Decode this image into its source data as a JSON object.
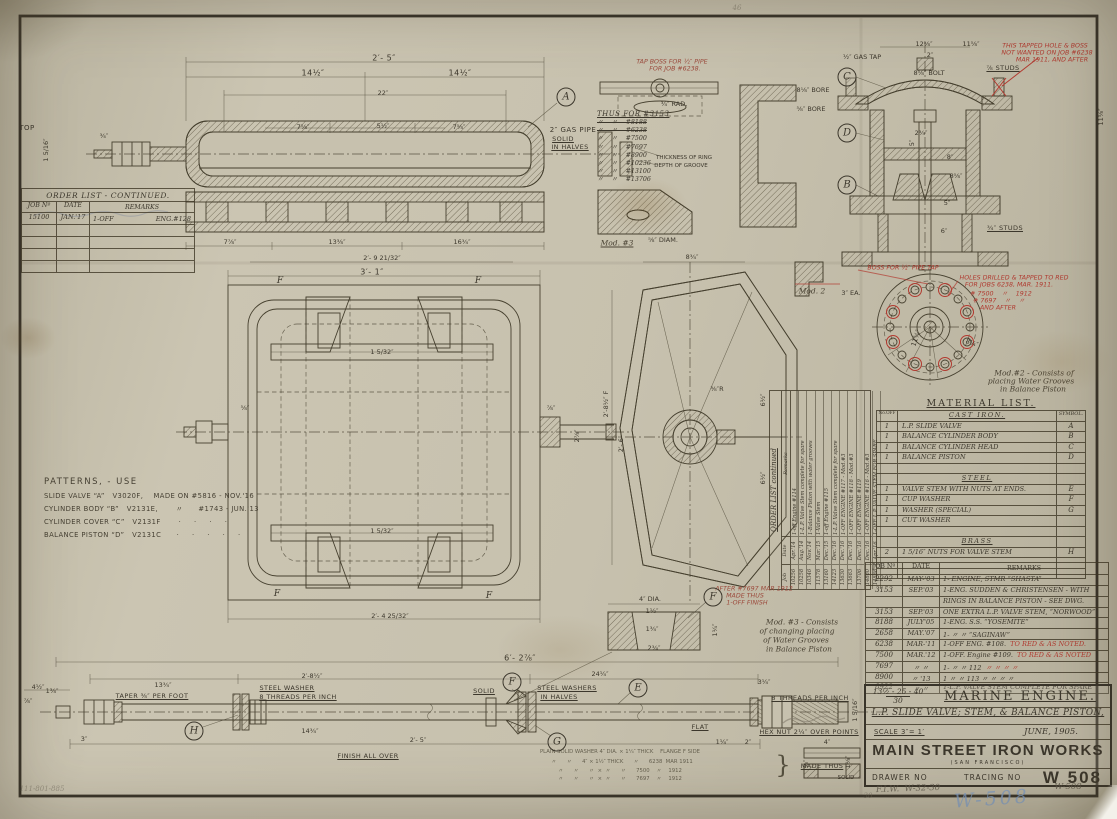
{
  "sheet": {
    "bg": "#c7c1ae",
    "ink": "#3c372c",
    "red": "#b03a30",
    "blue": "#7f9cc4"
  },
  "order_list_left": {
    "title": "ORDER LIST - CONTINUED.",
    "headers": [
      "JOB Nº",
      "DATE",
      "REMARKS"
    ],
    "rows": [
      {
        "job": "15100",
        "date": "JAN.'17",
        "rem": "1-OFF",
        "rem2": "ENG.#128"
      },
      {
        "job": "",
        "date": "",
        "rem": "",
        "rem2": ""
      },
      {
        "job": "",
        "date": "",
        "rem": "",
        "rem2": ""
      },
      {
        "job": "",
        "date": "",
        "rem": "",
        "rem2": ""
      },
      {
        "job": "",
        "date": "",
        "rem": "",
        "rem2": ""
      }
    ]
  },
  "patterns": {
    "title": "PATTERNS, - USE",
    "lines": [
      "SLIDE VALVE “A”   V3020F,    MADE ON #5816 - NOV.'16",
      "CYLINDER BODY “B”   V2131E,       〃      #1743 - JUN.'13",
      "CYLINDER COVER “C”   V2131F       ·     ·     ·     ·",
      "BALANCE PISTON “D”   V2131C      ·     ·     ·     ·     ·"
    ]
  },
  "thus_for": {
    "title": "THUS FOR #3153",
    "items": [
      {
        "t": "〃    〃    #8188",
        "s": true
      },
      {
        "t": "〃    〃    #6238",
        "s": true
      },
      {
        "t": "〃    〃    #7500",
        "s": false
      },
      {
        "t": "〃    〃    #7697",
        "s": false
      },
      {
        "t": "〃    〃    #8900",
        "s": false
      },
      {
        "t": "〃    〃    #10236",
        "s": false
      },
      {
        "t": "〃    〃    #13100",
        "s": false
      },
      {
        "t": "〃    〃    #13706",
        "s": false
      }
    ]
  },
  "rotated_order_list": {
    "title": "ORDER LIST continued",
    "headers": [
      "Job",
      "Date",
      "Remarks"
    ],
    "rows": [
      [
        "10256",
        "Apr.'14",
        "1-off Engine #114"
      ],
      [
        "10258",
        "Aug.'14",
        "1-L.P. Valve Stem complete for spare"
      ],
      [
        "10346",
        "Nov.'14",
        "1-Balance Piston with water grooves"
      ],
      [
        "11578",
        "Mar.'15",
        "1-Valve Stem"
      ],
      [
        "13160",
        "Dec.'15",
        "1-off Engine #115"
      ],
      [
        "14123",
        "Dec.'16",
        "1-L.P. Valve Stem complete for spare"
      ],
      [
        "13630",
        "Dec.'16",
        "1-OFF ENGINE #117 - Mod.#3"
      ],
      [
        "13663",
        "Dec.'16",
        "1-OFF ENGINE #118 - Mod.#3"
      ],
      [
        "13706",
        "Dec.'16",
        "1-OFF ENGINE #119"
      ],
      [
        "14880",
        "Dec.'16",
        "1-OFF ENGINE #116 - Mod.#3"
      ],
      [
        "14888",
        "Apr.'16",
        "1-OFF L.P. VALVE STEM FOR SPARE"
      ]
    ]
  },
  "material_list": {
    "title": "MATERIAL LIST.",
    "col_no": "No.OFF",
    "col_sym": "SYMBOL.",
    "sections": [
      {
        "name": "CAST IRON.",
        "gap": 1,
        "rows": [
          [
            "1",
            "L.P. SLIDE VALVE",
            "A"
          ],
          [
            "1",
            "BALANCE CYLINDER BODY",
            "B"
          ],
          [
            "1",
            "BALANCE CYLINDER HEAD",
            "C"
          ],
          [
            "1",
            "BALANCE PISTON",
            "D"
          ]
        ]
      },
      {
        "name": "STEEL",
        "gap": 1,
        "rows": [
          [
            "1",
            "VALVE STEM WITH NUTS AT ENDS.",
            "E"
          ],
          [
            "1",
            "CUP WASHER",
            "F"
          ],
          [
            "1",
            "WASHER  (SPECIAL)",
            "G"
          ],
          [
            "1",
            "CUT WASHER",
            ""
          ]
        ]
      },
      {
        "name": "BRASS",
        "gap": 2,
        "rows": [
          [
            "2",
            "1 5/16″ NUTS FOR VALVE STEM",
            "H"
          ]
        ]
      }
    ]
  },
  "record_table": {
    "headers": [
      "JOB Nº",
      "DATE",
      "REMARKS"
    ],
    "rows": [
      {
        "job": "2292",
        "date": "MAY-'03",
        "rem": "1- ENGINE,      STMR “SHASTA”",
        "red": ""
      },
      {
        "job": "3153",
        "date": "SEP.'03",
        "rem": "1-ENG. SUDDEN & CHRISTENSEN - WITH",
        "red": ""
      },
      {
        "job": "",
        "date": "",
        "rem": "RINGS IN BALANCE PISTON - SEE DWG.",
        "red": ""
      },
      {
        "job": "3153",
        "date": "SEP.'03",
        "rem": "ONE EXTRA L.P. VALVE STEM, “NORWOOD”",
        "red": ""
      },
      {
        "job": "8188",
        "date": "JULY'05",
        "rem": "1-ENG.   S.S. “YOSEMITE”",
        "red": ""
      },
      {
        "job": "2658",
        "date": "MAY.'07",
        "rem": "1- 〃      〃 “SAGINAW”",
        "red": ""
      },
      {
        "job": "6238",
        "date": "MAR-'11",
        "rem": "1-OFF  ENG. #108.",
        "red": "TO RED & AS NOTED."
      },
      {
        "job": "7500",
        "date": "MAR.'12",
        "rem": "1-OFF. Engine #109.",
        "red": "TO RED & AS NOTED"
      },
      {
        "job": "7697",
        "date": "〃   〃",
        "rem": "1- 〃       〃       112",
        "red": "〃   〃   〃   〃"
      },
      {
        "job": "8900",
        "date": "〃  '13",
        "rem": "1  〃       〃       113   〃   〃   〃   〃",
        "red": ""
      },
      {
        "job": "8922",
        "date": "〃   〃",
        "rem": "1-L.P. VALVE STEM COMPLETE FOR SPARE",
        "red": ""
      }
    ]
  },
  "title_block": {
    "ref_num": "13½ - 25 - 40",
    "ref_den": "30",
    "title": "MARINE ENGINE.",
    "subtitle": "L.P. SLIDE VALVE; STEM, & BALANCE PISTON,",
    "scale": "SCALE 3″= 1′",
    "date": "JUNE, 1905.",
    "company": "MAIN STREET IRON WORKS",
    "city": "(SAN FRANCISCO)",
    "drawer_label": "DRAWER NO",
    "tracing_label": "TRACING NO",
    "tracing_no": "W 508"
  },
  "annotations": [
    {
      "x": 737,
      "y": 8,
      "t": "46",
      "c": "pencilf",
      "n": "pencil-mark-46"
    },
    {
      "x": 27,
      "y": 128,
      "t": "TOP",
      "c": "lab",
      "n": "top-view-label"
    },
    {
      "x": 46,
      "y": 150,
      "t": "1 5/16″",
      "c": "dim",
      "r": -90
    },
    {
      "x": 104,
      "y": 136,
      "t": "¾″",
      "c": "dim"
    },
    {
      "x": 384,
      "y": 58,
      "t": "2′- 5″",
      "c": "dimb"
    },
    {
      "x": 313,
      "y": 73,
      "t": "14½″",
      "c": "dimb"
    },
    {
      "x": 460,
      "y": 73,
      "t": "14½″",
      "c": "dimb"
    },
    {
      "x": 383,
      "y": 93,
      "t": "22″",
      "c": "dim"
    },
    {
      "x": 303,
      "y": 127,
      "t": "7⅝″",
      "c": "dim"
    },
    {
      "x": 383,
      "y": 126,
      "t": "5½″",
      "c": "dim"
    },
    {
      "x": 459,
      "y": 127,
      "t": "7⅝″",
      "c": "dim"
    },
    {
      "x": 573,
      "y": 130,
      "t": "2″ GAS PIPE",
      "c": "lab",
      "n": "gas-pipe-label"
    },
    {
      "x": 563,
      "y": 139,
      "t": "SOLID",
      "c": "labu"
    },
    {
      "x": 570,
      "y": 147,
      "t": "IN HALVES",
      "c": "labu"
    },
    {
      "x": 230,
      "y": 242,
      "t": "7⅞″",
      "c": "dim"
    },
    {
      "x": 337,
      "y": 242,
      "t": "13⅜″",
      "c": "dim"
    },
    {
      "x": 462,
      "y": 242,
      "t": "16¾″",
      "c": "dim"
    },
    {
      "x": 382,
      "y": 258,
      "t": "2′- 9 21/32″",
      "c": "dim"
    },
    {
      "x": 372,
      "y": 272,
      "t": "3′- 1″",
      "c": "dimb"
    },
    {
      "x": 390,
      "y": 616,
      "t": "2′- 4 25/32″",
      "c": "dim"
    },
    {
      "x": 382,
      "y": 352,
      "t": "1 5/32″",
      "c": "dim"
    },
    {
      "x": 382,
      "y": 531,
      "t": "1 5/32″",
      "c": "dim"
    },
    {
      "x": 280,
      "y": 281,
      "t": "F",
      "c": "flab"
    },
    {
      "x": 478,
      "y": 281,
      "t": "F",
      "c": "flab"
    },
    {
      "x": 277,
      "y": 594,
      "t": "F",
      "c": "flab"
    },
    {
      "x": 489,
      "y": 596,
      "t": "F",
      "c": "flab"
    },
    {
      "x": 245,
      "y": 408,
      "t": "⅝″",
      "c": "dim"
    },
    {
      "x": 551,
      "y": 408,
      "t": "⅞″",
      "c": "dim"
    },
    {
      "x": 577,
      "y": 436,
      "t": "2⅞″",
      "c": "dim",
      "r": -90
    },
    {
      "x": 692,
      "y": 257,
      "t": "8¾″",
      "c": "dim"
    },
    {
      "x": 606,
      "y": 404,
      "t": "2′-8½″ F",
      "c": "dim",
      "r": -90
    },
    {
      "x": 621,
      "y": 444,
      "t": "2′- 6″",
      "c": "dim",
      "r": -90
    },
    {
      "x": 763,
      "y": 400,
      "t": "6½″",
      "c": "dim",
      "r": -90
    },
    {
      "x": 763,
      "y": 478,
      "t": "6½″",
      "c": "dim",
      "r": -90
    },
    {
      "x": 717,
      "y": 389,
      "t": "⅜″R",
      "c": "dim"
    },
    {
      "x": 672,
      "y": 62,
      "t": "TAP BOSS FOR ½″ PIPE",
      "c": "redf",
      "n": "tap-boss-note"
    },
    {
      "x": 675,
      "y": 69,
      "t": "FOR JOB #6238.",
      "c": "redf"
    },
    {
      "x": 674,
      "y": 104,
      "t": "¾″ RAD.",
      "c": "dim"
    },
    {
      "x": 813,
      "y": 90,
      "t": "8⅛″ BORE",
      "c": "dim"
    },
    {
      "x": 811,
      "y": 109,
      "t": "⅝″ BORE",
      "c": "dim"
    },
    {
      "x": 684,
      "y": 158,
      "t": "THICKNESS OF RING",
      "c": "labt"
    },
    {
      "x": 681,
      "y": 166,
      "t": "DEPTH OF GROOVE",
      "c": "labt"
    },
    {
      "x": 617,
      "y": 243,
      "t": "Mod. #3",
      "c": "scriptu",
      "n": "mod3-detail-label"
    },
    {
      "x": 663,
      "y": 240,
      "t": "⅝″ DIAM.",
      "c": "dim"
    },
    {
      "x": 862,
      "y": 57,
      "t": "½″ GAS TAP",
      "c": "dim"
    },
    {
      "x": 924,
      "y": 44,
      "t": "12⅝″",
      "c": "dim"
    },
    {
      "x": 971,
      "y": 44,
      "t": "11⅝″",
      "c": "dim"
    },
    {
      "x": 930,
      "y": 55,
      "t": "2″",
      "c": "dim"
    },
    {
      "x": 929,
      "y": 73,
      "t": "8⅝″ BOLT",
      "c": "dim"
    },
    {
      "x": 921,
      "y": 133,
      "t": "2¾″",
      "c": "dim"
    },
    {
      "x": 912,
      "y": 143,
      "t": "5″",
      "c": "dim",
      "r": -90
    },
    {
      "x": 950,
      "y": 157,
      "t": "8″",
      "c": "dim"
    },
    {
      "x": 956,
      "y": 176,
      "t": "8⅝″",
      "c": "dim"
    },
    {
      "x": 947,
      "y": 203,
      "t": "5″",
      "c": "dim"
    },
    {
      "x": 944,
      "y": 231,
      "t": "6″",
      "c": "dim"
    },
    {
      "x": 1101,
      "y": 117,
      "t": "11⅝″",
      "c": "dim",
      "r": -90
    },
    {
      "x": 1003,
      "y": 68,
      "t": "⅞ STUDS",
      "c": "labu"
    },
    {
      "x": 1005,
      "y": 228,
      "t": "¾″ STUDS",
      "c": "labu"
    },
    {
      "x": 1045,
      "y": 46,
      "t": "THIS TAPPED HOLE & BOSS",
      "c": "red",
      "n": "red-note-tapped-hole"
    },
    {
      "x": 1047,
      "y": 53,
      "t": "NOT WANTED ON JOB #6238",
      "c": "red"
    },
    {
      "x": 1052,
      "y": 60,
      "t": "MAR 1911, AND AFTER",
      "c": "red"
    },
    {
      "x": 812,
      "y": 291,
      "t": "Mod. 2",
      "c": "script",
      "n": "mod2-detail-label"
    },
    {
      "x": 851,
      "y": 293,
      "t": "3″ EA.",
      "c": "dim"
    },
    {
      "x": 903,
      "y": 268,
      "t": "BOSS FOR ½″ PIPE TAP",
      "c": "red",
      "n": "red-note-boss"
    },
    {
      "x": 1014,
      "y": 278,
      "t": "HOLES DRILLED & TAPPED TO RED",
      "c": "red",
      "n": "red-note-holes"
    },
    {
      "x": 1009,
      "y": 285,
      "t": "FOR JOBS 6238, MAR. 1911.",
      "c": "red"
    },
    {
      "x": 1001,
      "y": 293,
      "t": "# 7500    〃    1912",
      "c": "red"
    },
    {
      "x": 999,
      "y": 300,
      "t": "# 7697    〃    〃",
      "c": "red"
    },
    {
      "x": 998,
      "y": 308,
      "t": "AND AFTER",
      "c": "red"
    },
    {
      "x": 916,
      "y": 338,
      "t": "11⅝″",
      "c": "dim",
      "r": -72
    },
    {
      "x": 972,
      "y": 343,
      "t": "8¼″",
      "c": "dim",
      "r": 20
    },
    {
      "x": 1034,
      "y": 373,
      "t": "Mod.#2 - Consists of",
      "c": "script",
      "n": "mod2-note"
    },
    {
      "x": 1031,
      "y": 381,
      "t": "placing Water Grooves",
      "c": "script"
    },
    {
      "x": 1033,
      "y": 389,
      "t": "in Balance Piston",
      "c": "script"
    },
    {
      "x": 802,
      "y": 622,
      "t": "Mod. #3 - Consists",
      "c": "script",
      "n": "mod3-note"
    },
    {
      "x": 797,
      "y": 631,
      "t": "of changing placing",
      "c": "script"
    },
    {
      "x": 796,
      "y": 640,
      "t": "of Water Grooves",
      "c": "script"
    },
    {
      "x": 799,
      "y": 649,
      "t": "in Balance Piston",
      "c": "script"
    },
    {
      "x": 650,
      "y": 599,
      "t": "4″ DIA.",
      "c": "dim"
    },
    {
      "x": 652,
      "y": 611,
      "t": "1½″",
      "c": "dim"
    },
    {
      "x": 652,
      "y": 629,
      "t": "1¾″",
      "c": "dim"
    },
    {
      "x": 654,
      "y": 648,
      "t": "2¾″",
      "c": "dim"
    },
    {
      "x": 715,
      "y": 630,
      "t": "1¼″",
      "c": "dim",
      "r": -90
    },
    {
      "x": 754,
      "y": 589,
      "t": "AFTER #7697 MAR 1912",
      "c": "redf",
      "n": "after-7697-note"
    },
    {
      "x": 745,
      "y": 596,
      "t": "MADE THUS",
      "c": "redf"
    },
    {
      "x": 747,
      "y": 603,
      "t": "1-OFF FINISH",
      "c": "redf"
    },
    {
      "x": 38,
      "y": 687,
      "t": "4½″",
      "c": "dim"
    },
    {
      "x": 163,
      "y": 685,
      "t": "13¾″",
      "c": "dim"
    },
    {
      "x": 312,
      "y": 676,
      "t": "2′-8½″",
      "c": "dim"
    },
    {
      "x": 520,
      "y": 658,
      "t": "6′- 2⅞″",
      "c": "dimb"
    },
    {
      "x": 600,
      "y": 674,
      "t": "24¼″",
      "c": "dim"
    },
    {
      "x": 764,
      "y": 682,
      "t": "3¼″",
      "c": "dim"
    },
    {
      "x": 52,
      "y": 691,
      "t": "1⅜″",
      "c": "dim"
    },
    {
      "x": 28,
      "y": 701,
      "t": "⅞″",
      "c": "dim"
    },
    {
      "x": 152,
      "y": 696,
      "t": "TAPER ⅜″ PER FOOT",
      "c": "labu"
    },
    {
      "x": 287,
      "y": 688,
      "t": "STEEL WASHER",
      "c": "labu"
    },
    {
      "x": 298,
      "y": 697,
      "t": "8 THREADS PER INCH",
      "c": "labu"
    },
    {
      "x": 484,
      "y": 691,
      "t": "SOLID",
      "c": "labu"
    },
    {
      "x": 567,
      "y": 688,
      "t": "STEEL WASHERS",
      "c": "labu"
    },
    {
      "x": 559,
      "y": 697,
      "t": "IN HALVES",
      "c": "labu"
    },
    {
      "x": 700,
      "y": 727,
      "t": "FLAT",
      "c": "labu"
    },
    {
      "x": 810,
      "y": 698,
      "t": "8 THREADS PER INCH",
      "c": "labu"
    },
    {
      "x": 809,
      "y": 732,
      "t": "HEX NUT 2¼″ OVER POINTS",
      "c": "labu"
    },
    {
      "x": 855,
      "y": 710,
      "t": "1 5/16″",
      "c": "dim",
      "r": -90
    },
    {
      "x": 84,
      "y": 739,
      "t": "3″",
      "c": "dim"
    },
    {
      "x": 310,
      "y": 731,
      "t": "14¾″",
      "c": "dim"
    },
    {
      "x": 418,
      "y": 740,
      "t": "2′- 5″",
      "c": "dim"
    },
    {
      "x": 722,
      "y": 742,
      "t": "1¼″",
      "c": "dim"
    },
    {
      "x": 748,
      "y": 742,
      "t": "2″",
      "c": "dim"
    },
    {
      "x": 368,
      "y": 756,
      "t": "FINISH ALL OVER",
      "c": "labu",
      "n": "finish-note"
    },
    {
      "x": 620,
      "y": 752,
      "t": "PLAIN SOLID WASHER 4″ DIA. × 1¼″ THICK    FLANGE F SIDE",
      "c": "note",
      "n": "washer-note-line"
    },
    {
      "x": 622,
      "y": 761,
      "t": "〃      〃      4″ × 1½″ THICK      〃      6238  MAR 1911",
      "c": "note"
    },
    {
      "x": 620,
      "y": 770,
      "t": "〃      〃      〃  ×  〃      〃      7500    〃    1912",
      "c": "note"
    },
    {
      "x": 620,
      "y": 778,
      "t": "〃      〃      〃  ×  〃      〃      7697    〃    1912",
      "c": "note"
    },
    {
      "x": 783,
      "y": 765,
      "t": "}",
      "c": "brace"
    },
    {
      "x": 822,
      "y": 766,
      "t": "MADE THUS",
      "c": "labu",
      "n": "made-thus-label"
    },
    {
      "x": 827,
      "y": 742,
      "t": "4″",
      "c": "dim"
    },
    {
      "x": 848,
      "y": 762,
      "t": "1⅛″",
      "c": "dim",
      "r": -90
    },
    {
      "x": 806,
      "y": 764,
      "t": "⅞″",
      "c": "dim",
      "r": -90
    },
    {
      "x": 846,
      "y": 778,
      "t": "SOLID",
      "c": "labt"
    },
    {
      "x": 566,
      "y": 97,
      "t": "A",
      "c": "letter",
      "n": "ref-letter-A"
    },
    {
      "x": 847,
      "y": 77,
      "t": "C",
      "c": "letter",
      "n": "ref-letter-C"
    },
    {
      "x": 847,
      "y": 133,
      "t": "D",
      "c": "letter",
      "n": "ref-letter-D"
    },
    {
      "x": 847,
      "y": 185,
      "t": "B",
      "c": "letter",
      "n": "ref-letter-B"
    },
    {
      "x": 512,
      "y": 682,
      "t": "F",
      "c": "letter",
      "n": "ref-letter-F"
    },
    {
      "x": 638,
      "y": 688,
      "t": "E",
      "c": "letter",
      "n": "ref-letter-E"
    },
    {
      "x": 557,
      "y": 742,
      "t": "G",
      "c": "letter",
      "n": "ref-letter-G"
    },
    {
      "x": 194,
      "y": 731,
      "t": "H",
      "c": "letter",
      "n": "ref-letter-H"
    },
    {
      "x": 713,
      "y": 597,
      "t": "F",
      "c": "letter",
      "n": "ref-letter-F2"
    },
    {
      "x": 908,
      "y": 789,
      "t": "F.I.W.  W-32-30",
      "c": "pencil",
      "r": -2,
      "n": "pencil-fiw"
    },
    {
      "x": 1068,
      "y": 787,
      "t": "W-508",
      "c": "pencil",
      "n": "pencil-w508"
    },
    {
      "x": 992,
      "y": 799,
      "t": "W-508",
      "c": "blue",
      "r": -4,
      "n": "crayon-w508"
    },
    {
      "x": 868,
      "y": 796,
      "t": "30",
      "c": "pencilf"
    },
    {
      "x": 42,
      "y": 789,
      "t": "111-801-885",
      "c": "pencilf",
      "n": "pencil-catalog"
    }
  ]
}
